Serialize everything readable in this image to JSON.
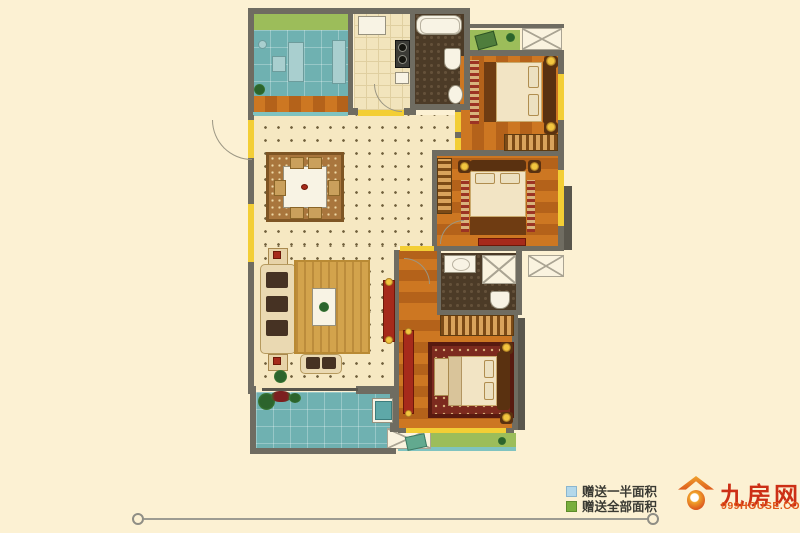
{
  "legend": {
    "items": [
      {
        "label": "赠送一半面积",
        "color": "#b3d8ea"
      },
      {
        "label": "赠送全部面积",
        "color": "#79ae3d"
      }
    ]
  },
  "logo": {
    "title": "九房网",
    "subtitle": "999HOUSE.COM"
  },
  "floorplan": {
    "rooms": [
      {
        "name": "study",
        "floor": "teal-grid",
        "gift_zone": "green-bay"
      },
      {
        "name": "kitchen",
        "floor": "cream-tile"
      },
      {
        "name": "bathroom-1",
        "floor": "dark-mosaic"
      },
      {
        "name": "bedroom-1",
        "floor": "wood"
      },
      {
        "name": "living-dining",
        "floor": "dotted-cream"
      },
      {
        "name": "bedroom-2",
        "floor": "wood"
      },
      {
        "name": "bathroom-2",
        "floor": "dark-mosaic"
      },
      {
        "name": "bedroom-3",
        "floor": "wood"
      },
      {
        "name": "balcony-south",
        "floor": "teal-tile"
      },
      {
        "name": "balcony-southeast",
        "floor": "green"
      },
      {
        "name": "balcony-north",
        "floor": "green"
      },
      {
        "name": "ac-platforms",
        "count": 3
      }
    ]
  },
  "colors": {
    "background": "#fcf1d3",
    "wall": "#6f6c61",
    "window": "#f3ce35",
    "cream_floor": "#f6e8c2",
    "wood_light": "#cd7722",
    "wood_dark": "#b4621a",
    "teal": "#6fb1b1",
    "green": "#9cbd5a",
    "dark_tile": "#4c3b27",
    "accent_red": "#a62a1b",
    "legend_blue": "#b3d8ea",
    "legend_green": "#79ae3d",
    "logo_red": "#cc2f16",
    "line": "#9d9c92"
  }
}
